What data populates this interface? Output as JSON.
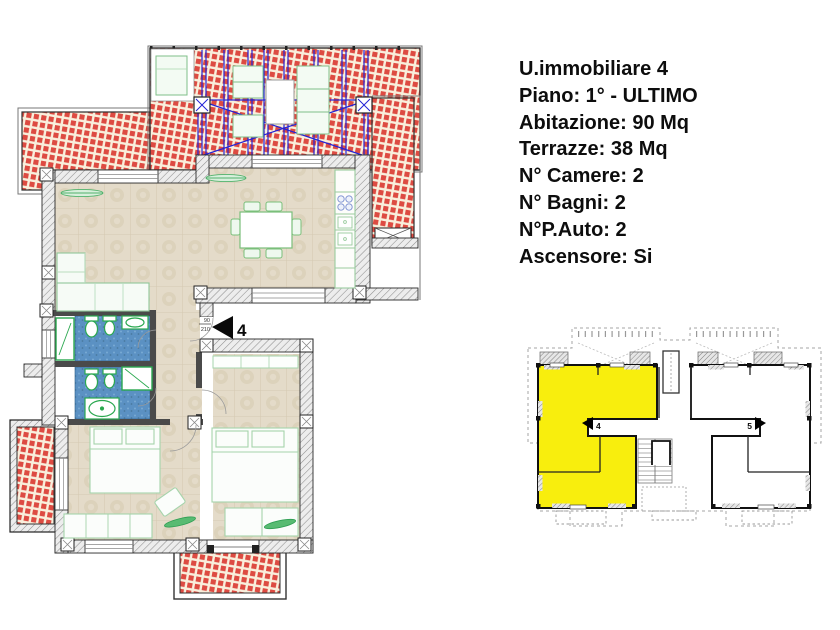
{
  "info": {
    "lines": [
      "U.immobiliare 4",
      "Piano: 1° - ULTIMO",
      "Abitazione: 90 Mq",
      "Terrazze: 38 Mq",
      "N° Camere: 2",
      "N° Bagni: 2",
      "N°P.Auto: 2",
      "Ascensore: Si"
    ]
  },
  "main_plan": {
    "entrance_unit": "4",
    "entrance_door_width_cm": "90",
    "entrance_door_height_cm": "210"
  },
  "key_plan": {
    "highlighted_unit": "4",
    "adjacent_unit": "5",
    "highlight_color": "#f8ee0d"
  },
  "palette": {
    "terrace_paving_red": "#dd4b42",
    "bathroom_tile_blue": "#5b91c3",
    "interior_floor_beige": "#e4dbc9",
    "fixture_green": "#2aa84f",
    "pergola_blue": "#2323d6",
    "text": "#111111"
  }
}
